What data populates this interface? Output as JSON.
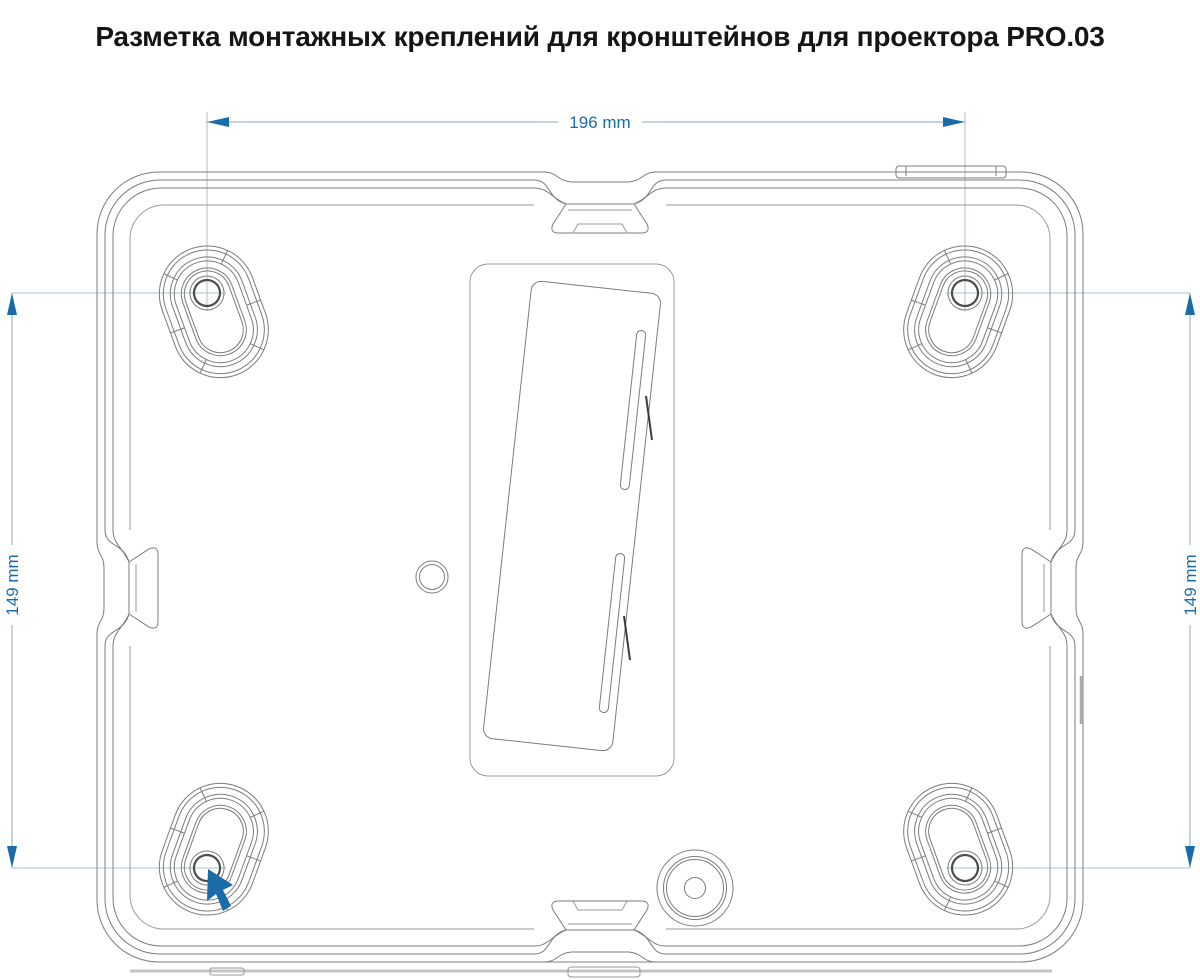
{
  "title": "Разметка монтажных креплений для кронштейнов для проектора PRO.03",
  "diagram": {
    "type": "mounting-hole-layout",
    "dimensions": {
      "width": "196 mm",
      "height_left": "149 mm",
      "height_right": "149 mm"
    },
    "colors": {
      "accent": "#1a6ca8",
      "dimension_line": "#8fa9bd",
      "extension_line": "#aac3ce",
      "outline": "#7c7c7c"
    }
  }
}
